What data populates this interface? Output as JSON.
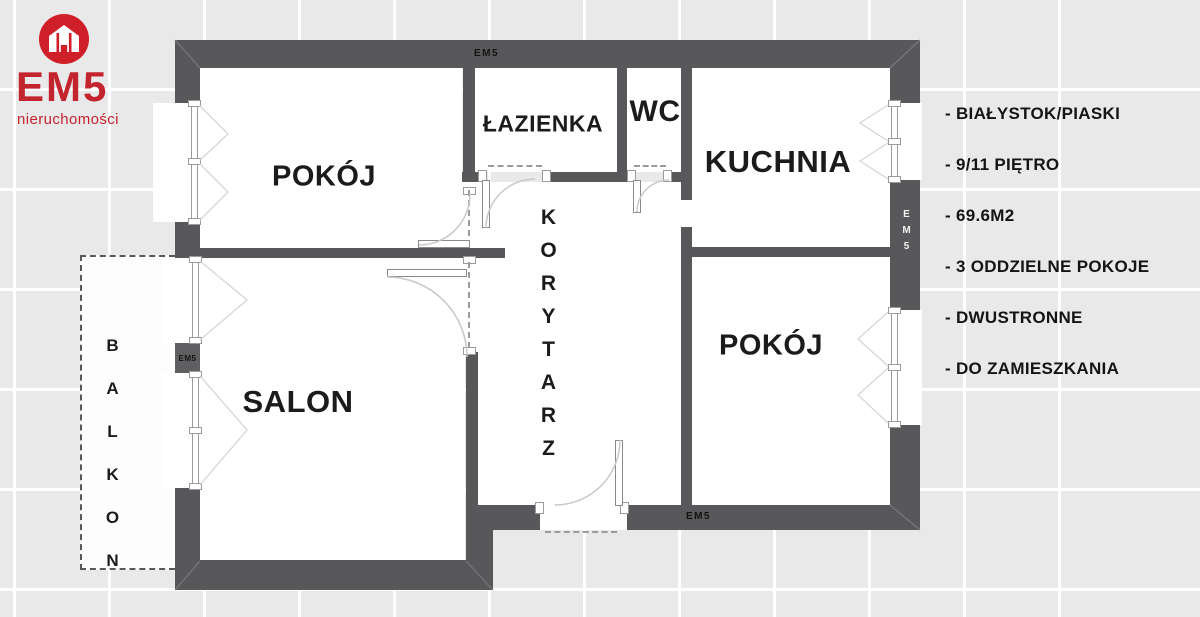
{
  "logo": {
    "brand": "EM5",
    "subtitle": "nieruchomości",
    "icon": "house-icon",
    "accent_red": "#c3242e"
  },
  "plan": {
    "rooms": {
      "pokoj_top": "POKÓJ",
      "lazienka": "ŁAZIENKA",
      "wc": "WC",
      "kuchnia": "KUCHNIA",
      "korytarz": "KORYTARZ",
      "pokoj_right": "POKÓJ",
      "salon": "SALON",
      "balkon": "BALKON"
    },
    "wall_labels": {
      "top": "EM5",
      "left": "EM5",
      "right": "EM5",
      "bottom": "EM5"
    },
    "colors": {
      "wall_gray": "#58585a",
      "room_white": "#ffffff",
      "label_black": "#1b1b1b"
    }
  },
  "details": {
    "items": [
      "- BIAŁYSTOK/PIASKI",
      "- 9/11 PIĘTRO",
      "- 69.6M2",
      "- 3 ODDZIELNE POKOJE",
      "- DWUSTRONNE",
      "- DO ZAMIESZKANIA"
    ]
  }
}
